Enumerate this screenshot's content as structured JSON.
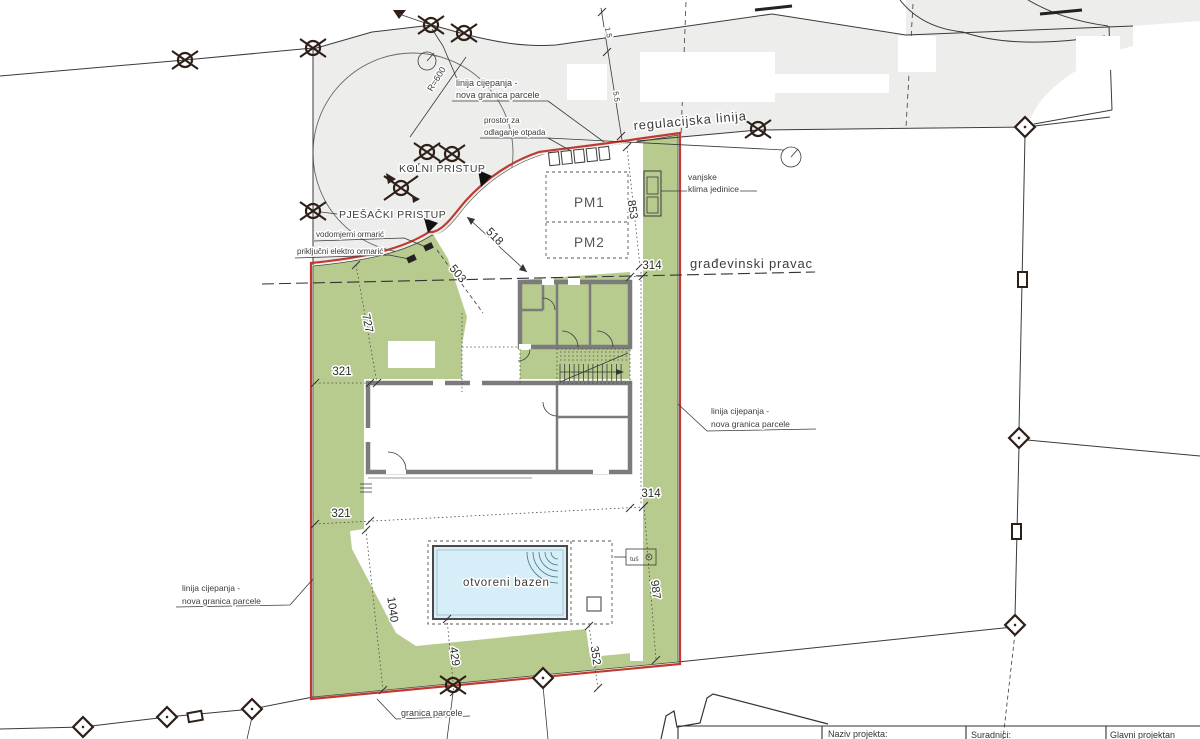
{
  "labels": {
    "linija_cijepanja_1": "linija cijepanja -",
    "linija_cijepanja_2": "nova granica parcele",
    "prostor_1": "prostor za",
    "prostor_2": "odlaganje otpada",
    "kolni_pristup": "KOLNI PRISTUP",
    "pjesacki_pristup": "PJEŠAČKI PRISTUP",
    "vodomjerni_ormaric": "vodomjerni ormarić",
    "prikljucni_ormaric": "priključni elektro ormarić",
    "regulacijska_linija": "regulacijska linija",
    "vanjske_1": "vanjske",
    "vanjske_2": "klima jedinice",
    "gradevinski_pravac": "građevinski pravac",
    "pm1": "PM1",
    "pm2": "PM2",
    "granica_parcele": "granica parcele",
    "otvoreni_bazen": "otvoreni bazen",
    "tus": "tuš",
    "radius": "R=600"
  },
  "dimensions": {
    "d853": "853",
    "d518": "518",
    "d503": "503",
    "d727": "727",
    "d321a": "321",
    "d321b": "321",
    "d314a": "314",
    "d314b": "314",
    "d1040": "1040",
    "d429": "429",
    "d352": "352",
    "d987": "987",
    "d15": "1.5",
    "d55": "5.5"
  },
  "title_block": {
    "naziv_projekta": "Naziv projekta:",
    "suradnici": "Suradnici:",
    "glavni_projektant": "Glavni projektan"
  },
  "colors": {
    "parcel_green": "#b8cb8e",
    "road_gray": "#ededeb",
    "boundary_red": "#c03a30",
    "pool_blue": "#d6eef7",
    "wall_gray": "#7b7b7b"
  }
}
